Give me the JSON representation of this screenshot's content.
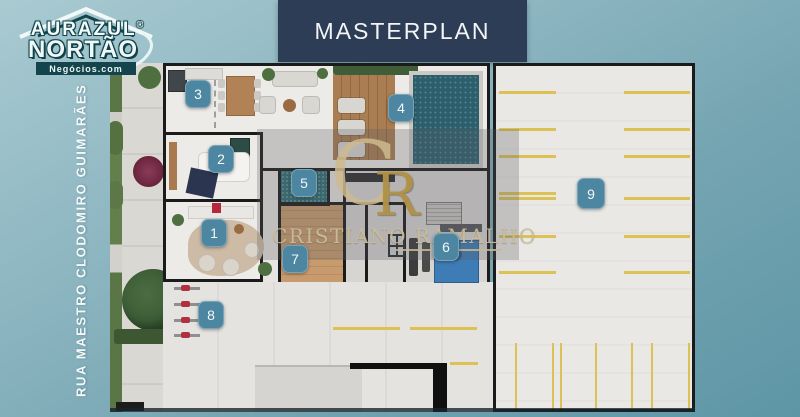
{
  "header": {
    "title": "MASTERPLAN"
  },
  "logo": {
    "name_top": "AURAZUL",
    "registered": "®",
    "name_main": "NORTÃO",
    "tagline": "Negócios.com"
  },
  "street": {
    "name": "RUA MAESTRO CLODOMIRO GUIMARÃES"
  },
  "watermark": {
    "monogram_c": "C",
    "monogram_r": "R",
    "name": "CRISTIANO RAMALHO"
  },
  "plan": {
    "badges": [
      "1",
      "2",
      "3",
      "4",
      "5",
      "6",
      "7",
      "8",
      "9"
    ]
  },
  "colors": {
    "background_top": "#a9cad1",
    "background_bottom": "#5e96a6",
    "banner": "#2d3d56",
    "badge": "#4c86a1",
    "pool": "#2c5f6b",
    "deck_wood": "#aa7d52",
    "parking_line": "#dcc254",
    "watermark_gold": "#b29245",
    "logo_teal": "#14454d"
  }
}
